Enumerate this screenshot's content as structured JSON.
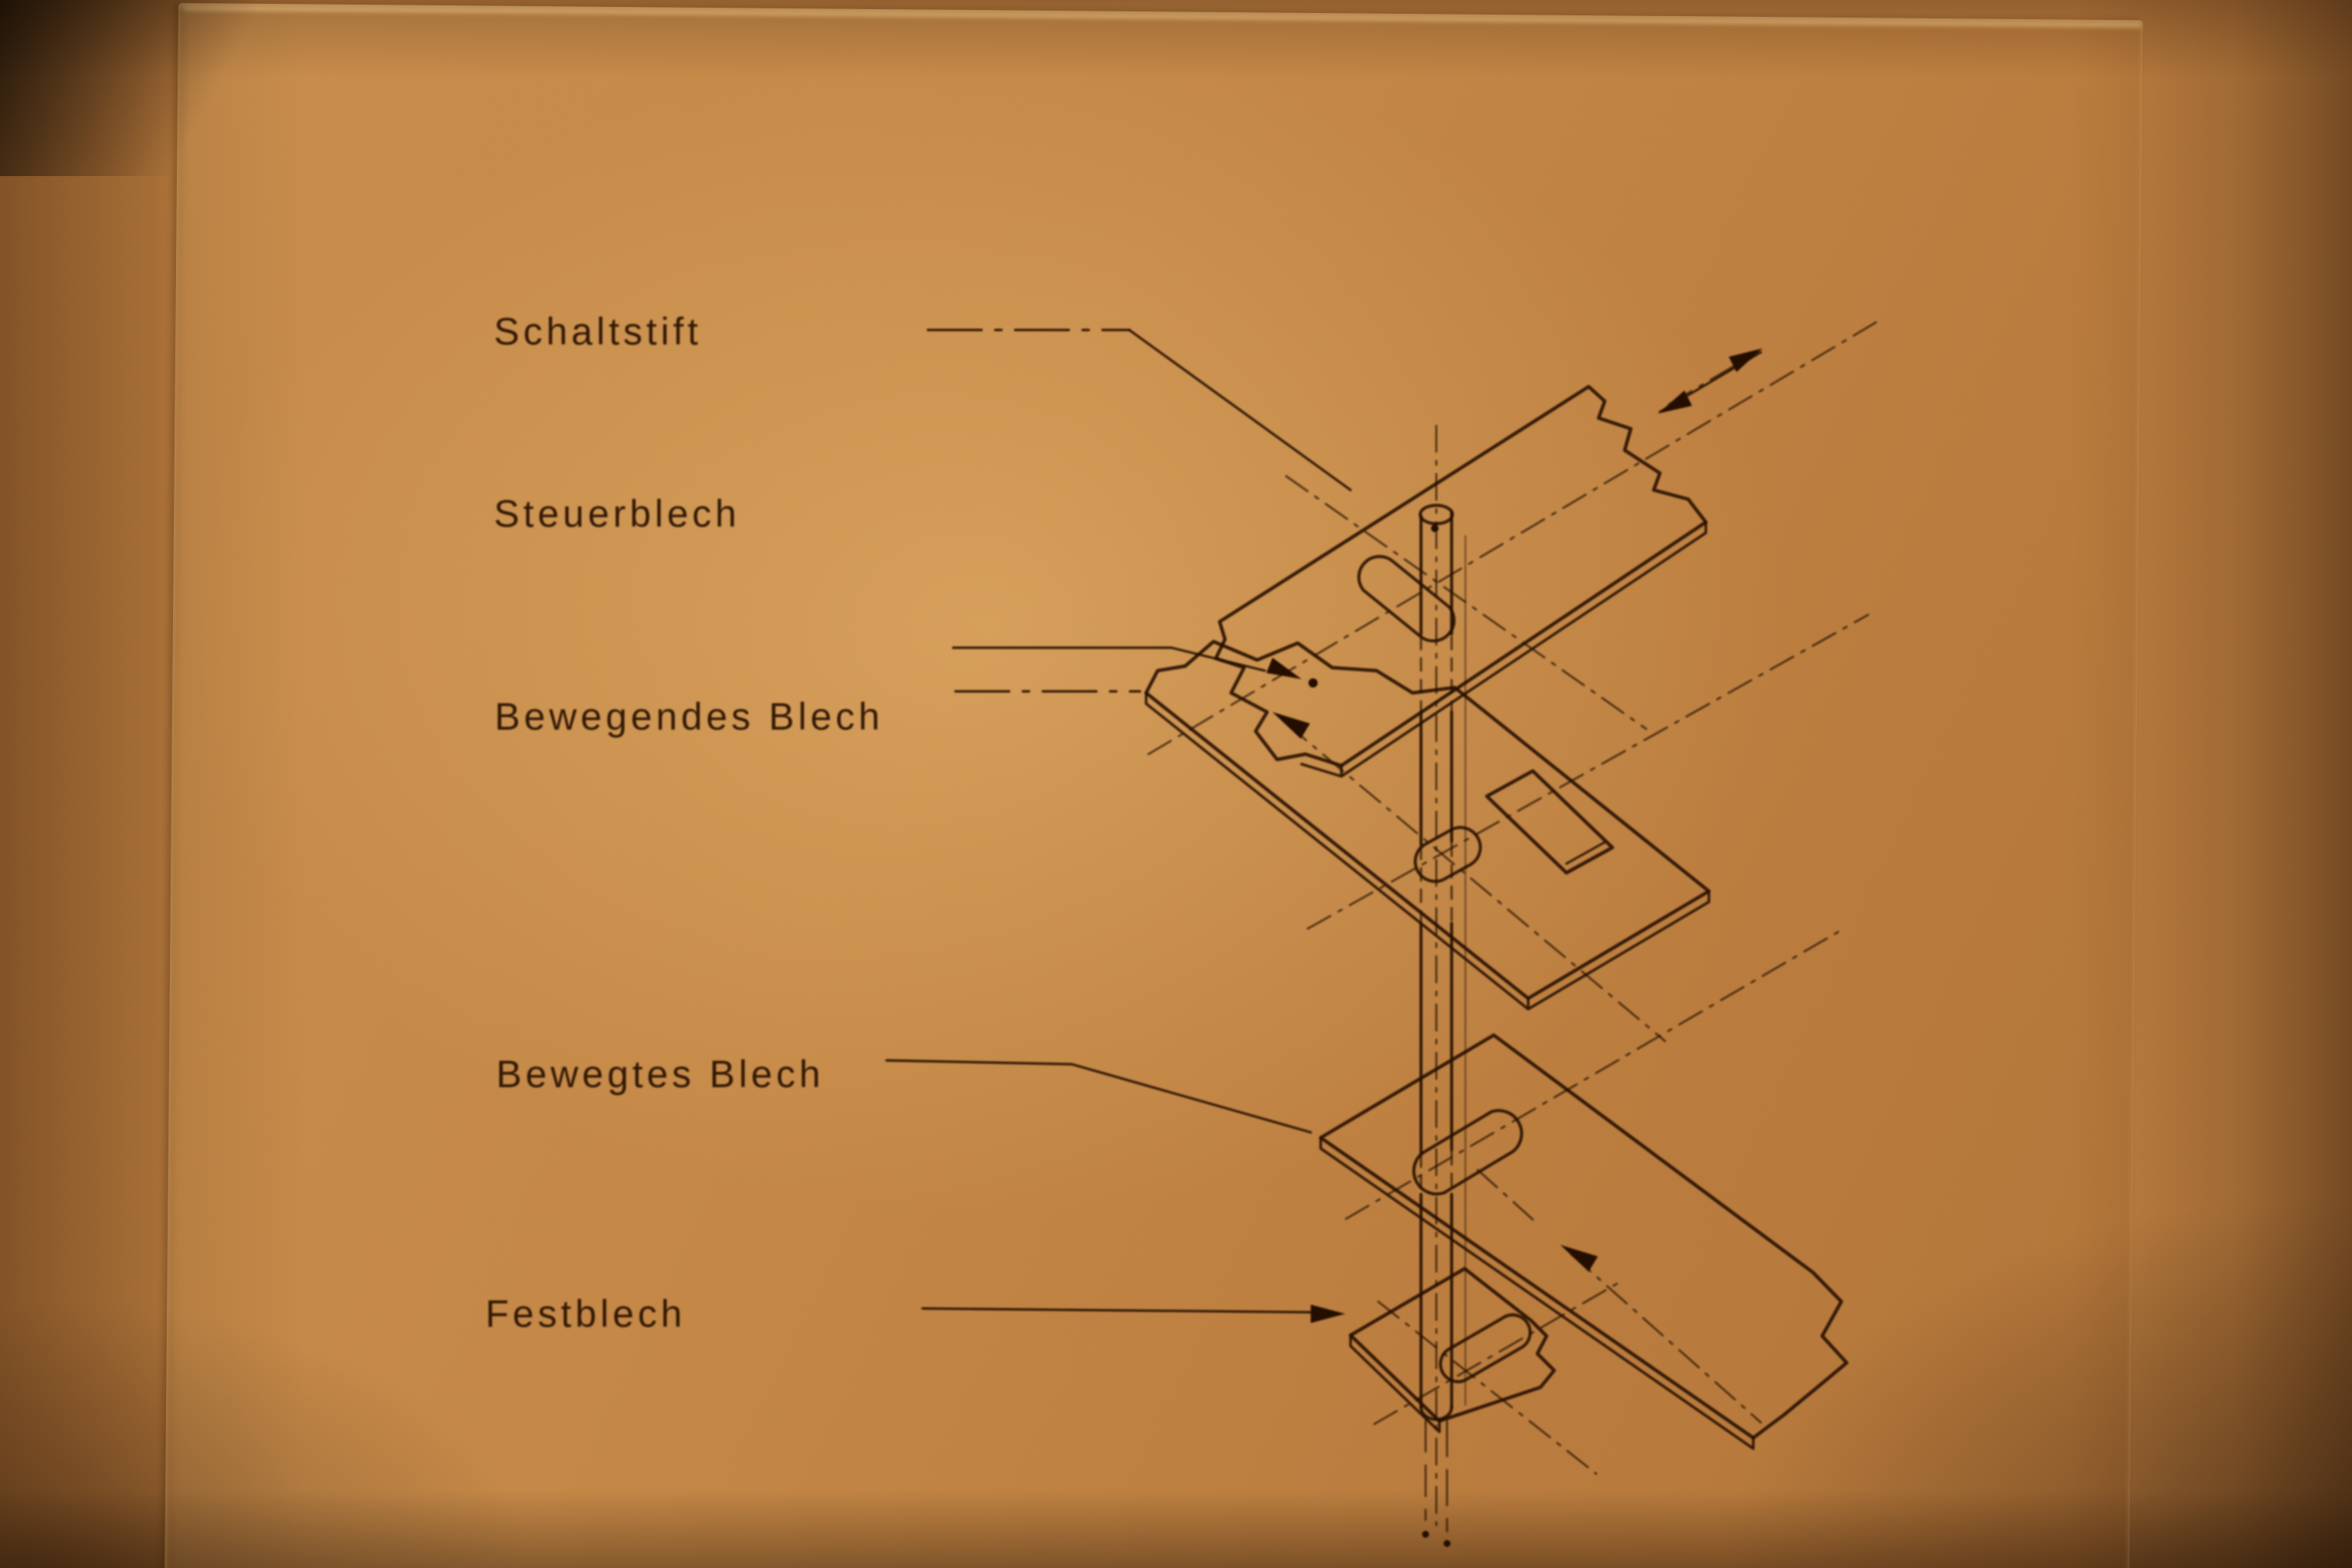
{
  "photo": {
    "subject": "exploded isometric technical drawing of a sliding switch pin mechanism",
    "language": "de",
    "paper_color": "#c98e4f",
    "ink_color": "#241103",
    "vignette_color": "#2c150427"
  },
  "diagram": {
    "labels": [
      {
        "id": "schaltstift",
        "text": "Schaltstift"
      },
      {
        "id": "steuerblech",
        "text": "Steuerblech"
      },
      {
        "id": "bewegendes-blech",
        "text": "Bewegendes Blech"
      },
      {
        "id": "bewegtes-blech",
        "text": "Bewegtes Blech"
      },
      {
        "id": "festblech",
        "text": "Festblech"
      }
    ],
    "annotations": {
      "motion_axis": "double-headed arrow, upper right",
      "plate_motion_arrows": 2,
      "leader_style": "thin solid and dash-dot leader lines from labels to parts"
    }
  }
}
